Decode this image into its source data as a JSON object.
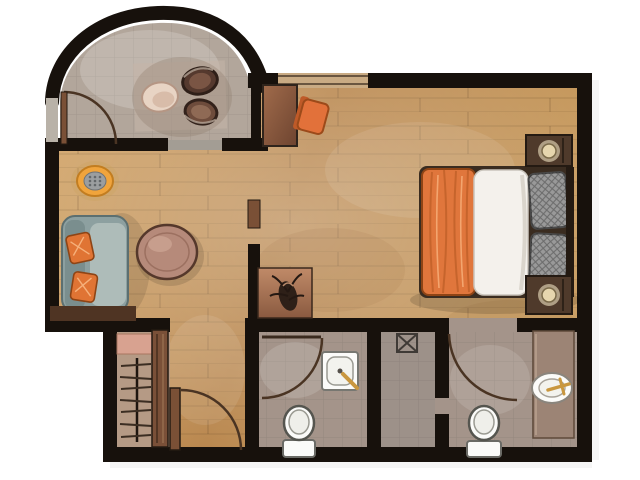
{
  "canvas": {
    "width": 640,
    "height": 480,
    "background": "#ffffff"
  },
  "scene": {
    "type": "floor-plan",
    "style": "hand-painted-watercolor-top-view",
    "rooms": [
      {
        "id": "dining-nook",
        "label": "arched dining nook with table set"
      },
      {
        "id": "living-area",
        "label": "living area with sofa and coffee table"
      },
      {
        "id": "bedroom-area",
        "label": "bedroom area with double bed"
      },
      {
        "id": "hallway",
        "label": "entry hallway"
      },
      {
        "id": "closet",
        "label": "wardrobe closet with hangers"
      },
      {
        "id": "bathroom-1",
        "label": "bathroom with square sink and toilet"
      },
      {
        "id": "shower-room",
        "label": "shower room with floor drain"
      },
      {
        "id": "bathroom-2",
        "label": "bathroom with vanity counter, oval sink and toilet"
      }
    ],
    "furniture": [
      {
        "id": "dining-plate",
        "label": "cream oval platter"
      },
      {
        "id": "dining-bowl-1",
        "label": "dark round bowl"
      },
      {
        "id": "dining-bowl-2",
        "label": "brown round bowl"
      },
      {
        "id": "desk",
        "label": "wooden desk"
      },
      {
        "id": "desk-chair",
        "label": "orange chair"
      },
      {
        "id": "sofa",
        "label": "teal-grey sofa with two orange pillows"
      },
      {
        "id": "coffee-table",
        "label": "oval coffee table"
      },
      {
        "id": "floor-stool",
        "label": "round orange-rimmed stool"
      },
      {
        "id": "console-table",
        "label": "console with dark decor object"
      },
      {
        "id": "bed",
        "label": "double bed: orange throw, white duvet, grey pillows"
      },
      {
        "id": "nightstand-top",
        "label": "nightstand with lamp"
      },
      {
        "id": "nightstand-bottom",
        "label": "nightstand with lamp"
      },
      {
        "id": "wardrobe",
        "label": "wardrobe: shelf, rod, hangers, sliding panel"
      },
      {
        "id": "toilet-1",
        "label": "toilet"
      },
      {
        "id": "toilet-2",
        "label": "toilet"
      },
      {
        "id": "square-sink",
        "label": "square basin with gold tap"
      },
      {
        "id": "oval-sink",
        "label": "oval basin with gold tap"
      },
      {
        "id": "shower-drain",
        "label": "crossed square shower drain"
      },
      {
        "id": "doors",
        "label": "4 swing doors with quarter-circle arcs"
      },
      {
        "id": "window",
        "label": "wide opening in top wall"
      }
    ]
  },
  "colors": {
    "wall": "#17110c",
    "wood_floor": "#c59a60",
    "nook_floor": "#b2a69b",
    "bath_floor": "#a4948a",
    "shower_floor": "#9d9189",
    "threshold": "#a39d94",
    "window_fill": "#c9ab84",
    "door_arc": "#4a3423",
    "door_leaf": "#7a5036",
    "sofa_body": "#8da0a0",
    "sofa_seat": "#aebcb9",
    "pillow_orange": "#e07434",
    "coffee_table": "#b68a7a",
    "stool_ring": "#f0a43c",
    "stool_center": "#9b9ea0",
    "bed_blanket": "#e0763c",
    "bed_duvet": "#f4f1ec",
    "bed_pillow": "#999999",
    "bed_frame": "#2f241c",
    "nightstand": "#4f3a2b",
    "lamp": "#e6d6ae",
    "desk": "#8f5f43",
    "chair_orange": "#e2713a",
    "closet_interior": "#b59a85",
    "closet_shelf": "#d8a290",
    "closet_panel": "#7a5038",
    "counter": "#9c8475",
    "fixture_white": "#fbfbf9",
    "faucet_gold": "#c9973f",
    "table_plate": "#e8d4c4",
    "bowl_dark": "#55392e",
    "bowl_brown": "#6e4c3c",
    "console": "#b97f63",
    "plant_dark": "#2e2018"
  }
}
